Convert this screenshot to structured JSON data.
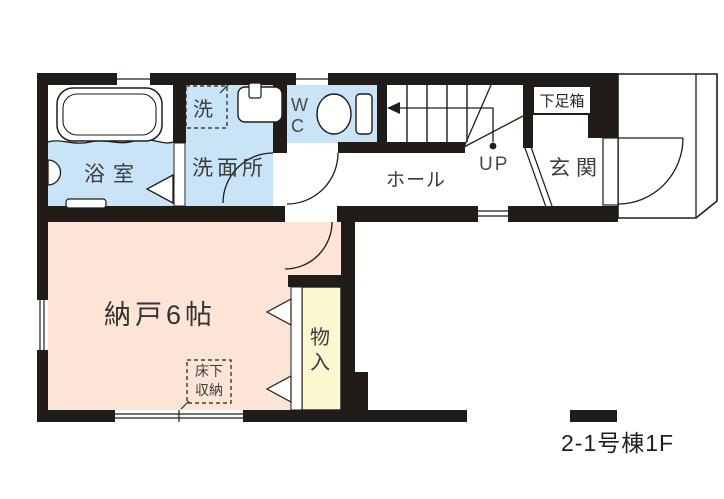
{
  "plan": {
    "caption": "2-1号棟1F",
    "rooms": {
      "bathroom": {
        "label": "浴室",
        "color": "#c8e4f6"
      },
      "washroom": {
        "label": "洗面所",
        "color": "#c8e4f6"
      },
      "washer_space": {
        "label": "洗"
      },
      "toilet": {
        "label": "WC",
        "color": "#c8e4f6"
      },
      "hall": {
        "label": "ホール",
        "color": "#ffffff"
      },
      "stairs": {
        "label": "UP"
      },
      "entrance": {
        "label": "玄関",
        "color": "#ffffff"
      },
      "shoebox": {
        "label": "下足箱"
      },
      "storage_room": {
        "label": "納戸6帖",
        "color": "#fce4d6"
      },
      "underfloor_storage": {
        "label": "床下収納"
      },
      "closet": {
        "label": "物入",
        "color": "#fbf8d0"
      }
    },
    "colors": {
      "wall": "#221c18",
      "line": "#1d1d1b",
      "room_blue": "#c8e4f6",
      "room_peach": "#fce4d6",
      "closet_yellow": "#fbf8d0",
      "label_gray": "#3c3c3c"
    }
  }
}
